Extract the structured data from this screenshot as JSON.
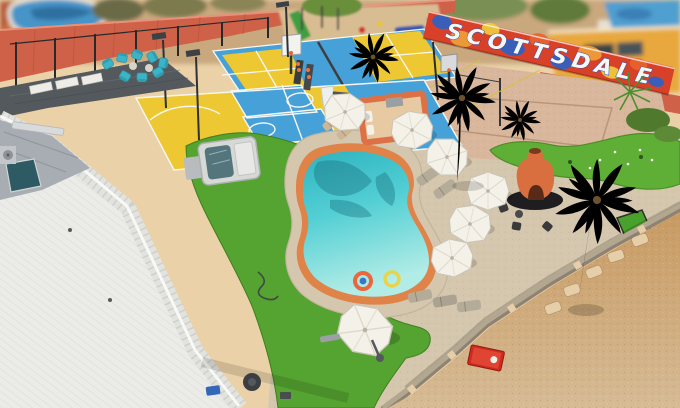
{
  "scene": {
    "alt": "Aerial drone view of a backyard resort in Scottsdale with sport courts, kidney-shaped pool, putting green, palm trees and desert strip",
    "banner_text": "SCOTTSDALE"
  },
  "palette": {
    "patio": "#ead1a8",
    "wall": "#cf6148",
    "wall_seam": "#b9543a",
    "sand": "#d9b79c",
    "gravel": "#d5c7ae",
    "turf": "#55a330",
    "turf_dark": "#3f7d20",
    "putting": "#5fae35",
    "pool_deep": "#2fb3c0",
    "pool_mid": "#52cfd4",
    "pool_shallow": "#b2ece6",
    "coping": "#df8349",
    "court_blue": "#46a1d8",
    "court_yellow": "#eec832",
    "line_white": "#f7f7f2",
    "roof": "#ebebe7",
    "roof_gray": "#a7adb2",
    "mat": "#54595e",
    "dirt_top": "#c89a62",
    "dirt_bottom": "#d6bb95",
    "dirt_pad": "#e6cfa8",
    "wall_low": "#b3a78f",
    "umbrella": "#f4f1e9",
    "chair_teal": "#3ab4c6",
    "fireplace": "#d96f3f",
    "bldg_yellow": "#e8a83c",
    "slide_green": "#3f9e3f",
    "cornhole_red": "#cf2a1f",
    "banner_red": "#d94028",
    "banner_blue": "#2b62c8",
    "banner_orange": "#f0a23a",
    "banner_yellow": "#f2cf3e",
    "banner_outline": "#1d4fc0",
    "bg_pool": "#4694c8",
    "hose_dark": "#3f4a42"
  }
}
